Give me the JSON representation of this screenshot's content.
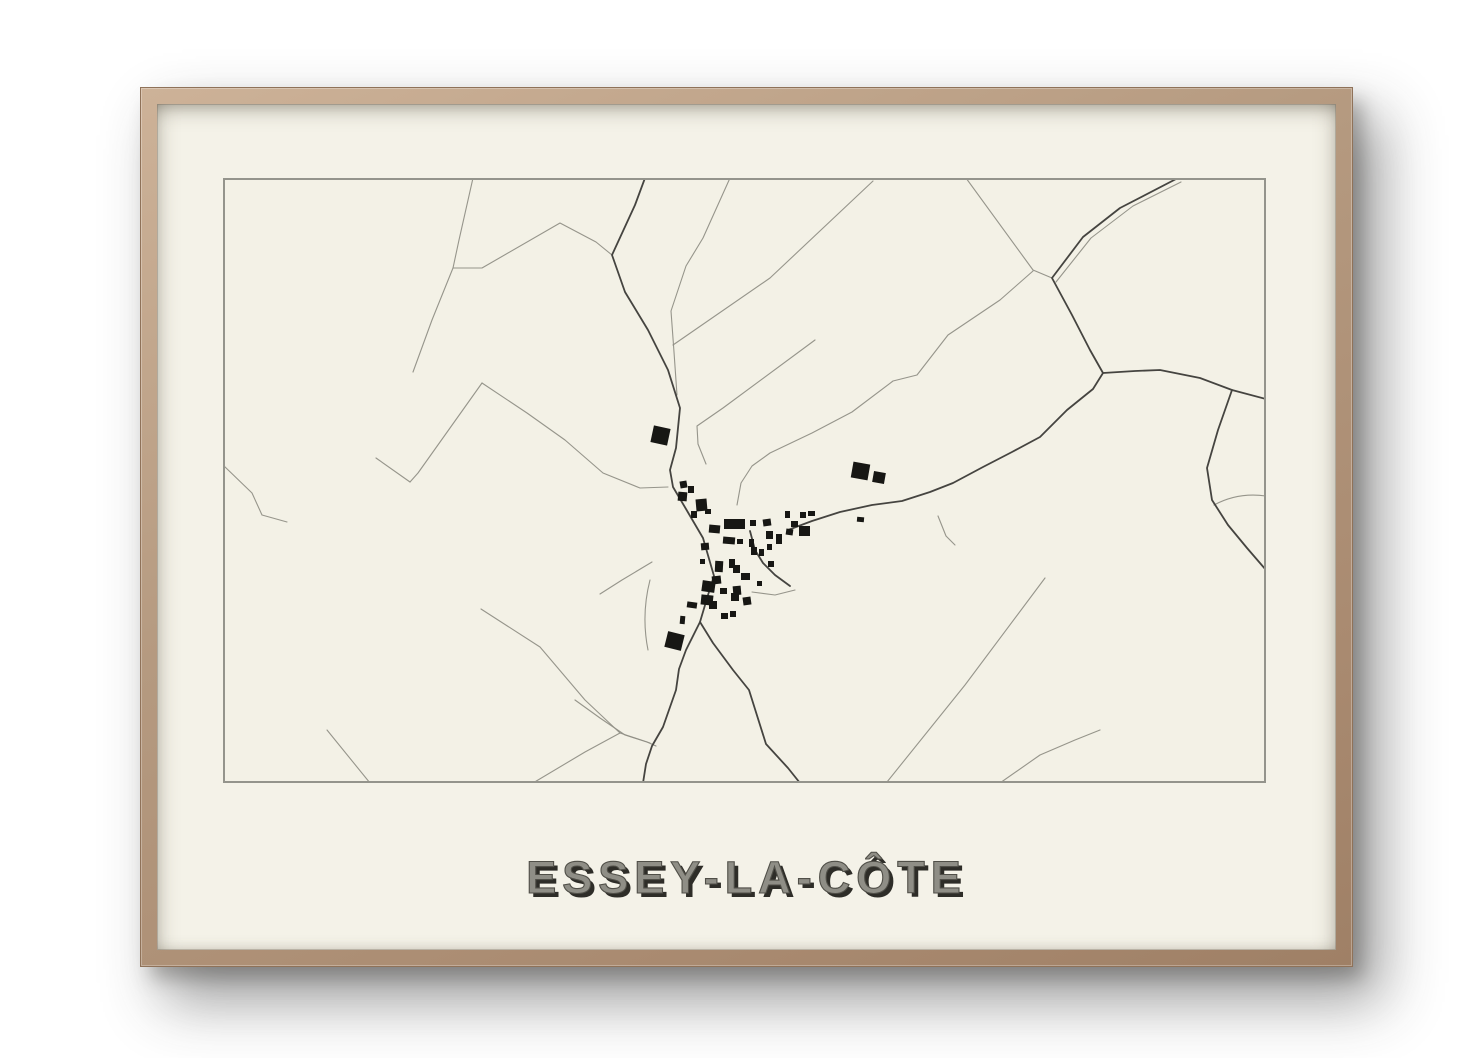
{
  "poster": {
    "title": "ESSEY-LA-CÔTE",
    "colors": {
      "wall": "#ffffff",
      "frame_wood": "#b59a80",
      "paper": "#f4f2e8",
      "map_background": "#f3f1e6",
      "map_border": "#94948c",
      "road_dark": "#454440",
      "road_light": "#908f86",
      "building": "#171714",
      "title_fill": "#8f8e86",
      "title_shadow": "#2e2d28"
    }
  },
  "map": {
    "viewbox": "0 0 1043 605",
    "roads_dark": [
      "M422 0 L412 27 L389 77 L402 114 L425 152 L445 192 L457 230 L453 270 L447 292 L450 309 L463 331 L480 360 L491 398 L485 417 L477 444 L463 472 L456 491 L453 512 L440 549 L429 568 L423 586 L420 605",
      "M477 444 L490 465 L510 492 L526 512 L543 566 L565 590 L577 605",
      "M565 352 L589 343 L617 334 L649 327 L679 323 L707 314 L730 305 L760 289 L789 274 L817 259 L844 232 L870 211 L880 195 L867 172 L849 137 L829 100 L860 59 L897 30 L955 0",
      "M880 195 L912 193 L937 192 L977 200 L1009 212 L1043 221",
      "M1009 212 L995 252 L984 290 L989 322 L1005 347 L1024 370 L1043 392",
      "M527 353 L532 372 L540 385 L552 397 L567 408"
    ],
    "roads_light": [
      "M250 0 L236 62 L230 90 L209 142 L190 194",
      "M230 90 L259 90 L337 45 L373 64 L389 77",
      "M507 0 L489 40 L480 60 L463 88 L448 133 L451 174 L454 217",
      "M650 3 L547 100 L450 167",
      "M810 93 L777 122 L725 157 L694 197 L670 203 L629 234 L589 255 L547 275 L529 288 L518 305 L514 327",
      "M592 162 L500 230 L474 248 L475 266 L483 286",
      "M743 0 L810 92 L829 100",
      "M259 205 L304 235 L342 262 L380 295 L417 310 L445 309",
      "M259 205 L195 295 L187 304",
      "M187 304 L153 280",
      "M0 287 L29 315 L39 337 L64 344",
      "M429 384 L399 402 L377 416",
      "M352 522 L377 540 L402 557 L424 564 L433 568",
      "M258 431 L317 469 L362 522 L397 555 L427 565",
      "M664 604 L742 507 L822 400",
      "M715 338 L723 358 L732 367",
      "M777 605 L817 577 L852 562 L877 552",
      "M104 552 L147 605",
      "M310 605 L362 574 L397 555",
      "M833 104 L868 60 L910 28 L958 4",
      "M991 327 Q1015 314 1043 318",
      "M425 472 Q418 437 427 402",
      "M529 414 L552 417 L572 412"
    ],
    "buildings": [
      [
        429,
        249,
        17,
        17,
        12
      ],
      [
        629,
        285,
        17,
        16,
        10
      ],
      [
        650,
        294,
        12,
        11,
        10
      ],
      [
        634,
        339,
        7,
        5,
        5
      ],
      [
        457,
        303,
        7,
        7,
        -10
      ],
      [
        465,
        308,
        6,
        7,
        0
      ],
      [
        455,
        314,
        9,
        9,
        5
      ],
      [
        473,
        321,
        11,
        12,
        -5
      ],
      [
        468,
        333,
        6,
        7,
        0
      ],
      [
        482,
        331,
        6,
        5,
        0
      ],
      [
        486,
        347,
        11,
        8,
        5
      ],
      [
        501,
        341,
        21,
        10,
        0
      ],
      [
        527,
        342,
        6,
        6,
        0
      ],
      [
        540,
        341,
        8,
        7,
        -8
      ],
      [
        562,
        333,
        5,
        7,
        0
      ],
      [
        568,
        343,
        7,
        6,
        0
      ],
      [
        577,
        334,
        6,
        6,
        0
      ],
      [
        585,
        333,
        7,
        5,
        0
      ],
      [
        563,
        351,
        7,
        6,
        8
      ],
      [
        576,
        348,
        11,
        10,
        0
      ],
      [
        543,
        353,
        7,
        8,
        0
      ],
      [
        553,
        356,
        6,
        10,
        0
      ],
      [
        500,
        359,
        12,
        7,
        5
      ],
      [
        514,
        361,
        6,
        5,
        0
      ],
      [
        526,
        361,
        5,
        8,
        0
      ],
      [
        528,
        369,
        6,
        8,
        0
      ],
      [
        536,
        371,
        5,
        7,
        0
      ],
      [
        544,
        366,
        5,
        6,
        0
      ],
      [
        478,
        365,
        8,
        7,
        -5
      ],
      [
        477,
        381,
        5,
        5,
        0
      ],
      [
        492,
        383,
        8,
        11,
        3
      ],
      [
        506,
        381,
        6,
        9,
        0
      ],
      [
        510,
        387,
        7,
        8,
        0
      ],
      [
        489,
        398,
        9,
        8,
        -6
      ],
      [
        479,
        403,
        13,
        11,
        8
      ],
      [
        497,
        410,
        7,
        6,
        0
      ],
      [
        518,
        395,
        9,
        7,
        0
      ],
      [
        510,
        408,
        8,
        9,
        -5
      ],
      [
        545,
        383,
        6,
        6,
        0
      ],
      [
        534,
        403,
        5,
        5,
        0
      ],
      [
        478,
        417,
        12,
        10,
        6
      ],
      [
        508,
        415,
        8,
        8,
        0
      ],
      [
        520,
        419,
        8,
        8,
        -8
      ],
      [
        464,
        424,
        10,
        6,
        8
      ],
      [
        486,
        423,
        8,
        8,
        0
      ],
      [
        457,
        438,
        5,
        8,
        5
      ],
      [
        498,
        435,
        7,
        6,
        0
      ],
      [
        507,
        433,
        6,
        6,
        0
      ],
      [
        443,
        455,
        17,
        16,
        14
      ]
    ]
  }
}
